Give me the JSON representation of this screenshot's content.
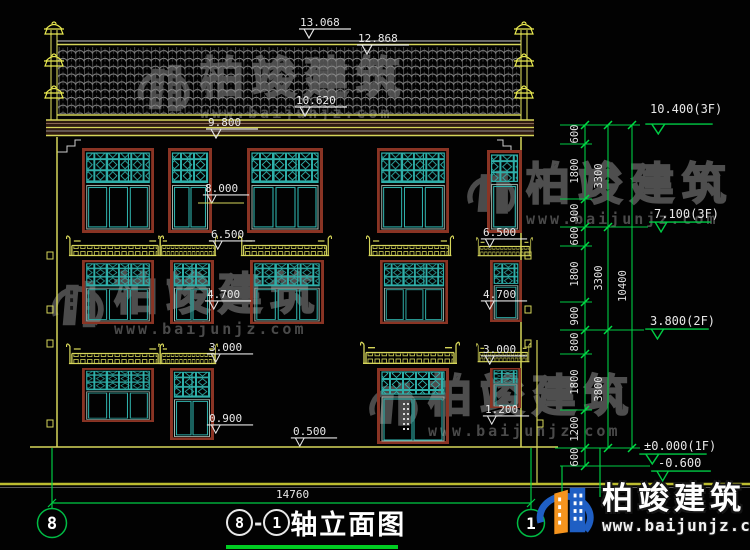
{
  "title": {
    "axis_left": "8",
    "separator": "-",
    "axis_right": "1",
    "text": "轴立面图"
  },
  "axes": {
    "left": "8",
    "right": "1"
  },
  "brand": {
    "name": "柏竣建筑",
    "url": "www.baijunjz.com"
  },
  "marks": {
    "ridge": "13.068",
    "ridge2": "12.868",
    "roof_low": "10.620",
    "eave": "9.800",
    "f3_sill": "8.000",
    "f2_awning": "6.500",
    "f2_sill": "4.700",
    "f1_awning": "3.000",
    "f1_door_sill": "1.200",
    "f1_sill": "0.900",
    "porch": "0.500"
  },
  "levels": {
    "l10400": "10.400(3F)",
    "l7100": "7.100(3F)",
    "l3800": "3.800(2F)",
    "l0": "±0.000(1F)",
    "lm600": "-0.600"
  },
  "dims": {
    "inner": [
      "600",
      "1800",
      "900",
      "600",
      "1800",
      "900",
      "800",
      "1800",
      "1200",
      "600"
    ],
    "middle": [
      "3300",
      "3300",
      "3800"
    ],
    "outer": [
      "10400"
    ],
    "width": "14760"
  }
}
